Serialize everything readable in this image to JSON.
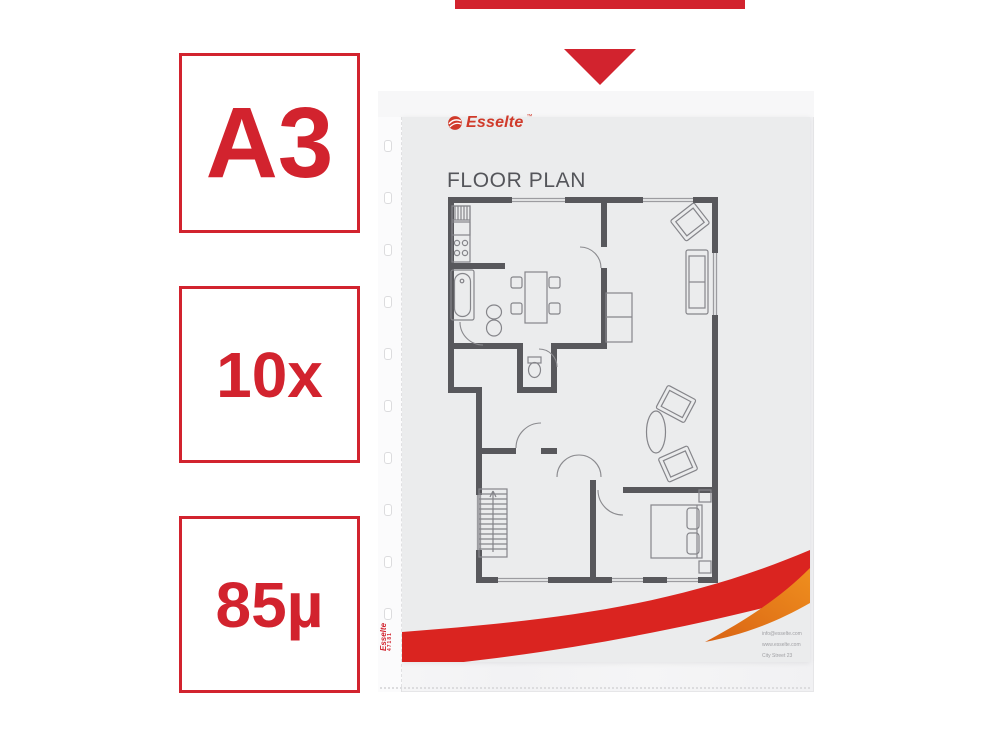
{
  "gallery_arrow": {
    "bar_color": "#d2232e",
    "triangle_color": "#d2232e"
  },
  "badges": [
    {
      "label": "A3"
    },
    {
      "label": "10x"
    },
    {
      "label": "85µ"
    }
  ],
  "badge_style": {
    "border_color": "#d2232e",
    "text_color": "#d2232e"
  },
  "sleeve": {
    "margin_brand": "Esselte",
    "margin_code": "47181",
    "punch_hole_count": 10
  },
  "document": {
    "brand": "Esselte",
    "brand_trademark": "™",
    "title": "FLOOR PLAN",
    "footer_lines": [
      "info@esselte.com",
      "www.esselte.com",
      "City Street 23"
    ],
    "accent_red": "#da2420",
    "accent_orange": "#e5761b"
  },
  "floor_plan": {
    "wall_color": "#58585c",
    "furniture_line_color": "#87878b",
    "elements": [
      "kitchen-stove",
      "kitchen-sink",
      "bathtub",
      "washbasin",
      "dining-table",
      "chairs",
      "toilet",
      "wardrobe",
      "sofa",
      "armchairs",
      "coffee-table",
      "staircase",
      "bed",
      "nightstands",
      "door-arcs",
      "windows"
    ]
  },
  "icons": {
    "esselte_swirl": "red circle with white swoosh stripes",
    "arrow_indicator": "red triangle pointing down"
  }
}
